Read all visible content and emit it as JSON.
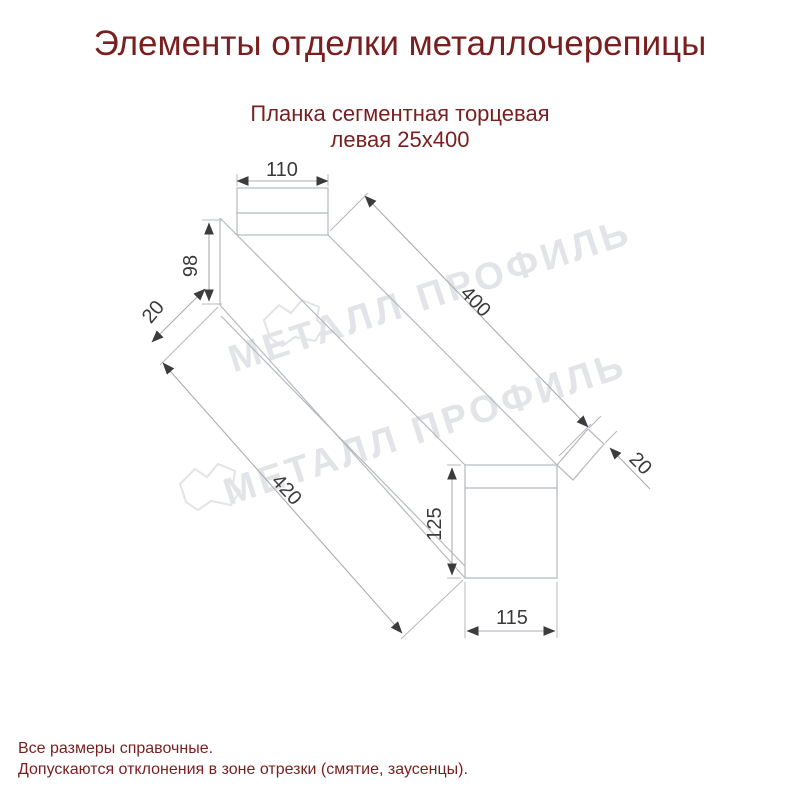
{
  "page": {
    "title": "Элементы отделки металлочерепицы"
  },
  "product": {
    "subtitle_line1": "Планка сегментная торцевая",
    "subtitle_line2": "левая 25х400"
  },
  "drawing": {
    "type": "isometric technical line drawing of left segmented end trim strip",
    "dimensions": {
      "top_flange_width": "110",
      "near_end_height": "98",
      "near_hem": "20",
      "top_length": "400",
      "bottom_length": "420",
      "far_end_height": "125",
      "far_end_width": "115",
      "far_hem": "20"
    }
  },
  "watermark": {
    "text": "МЕТАЛЛ ПРОФИЛЬ"
  },
  "footer": {
    "line1": "Все размеры справочные.",
    "line2": "Допускаются отклонения в зоне отрезки (смятие, заусенцы)."
  },
  "colors": {
    "heading_text": "#7a1f1f",
    "dimension_text": "#3a3a3a",
    "drawing_line": "#b5b9be",
    "watermark": "#e2e4e7",
    "background": "#ffffff"
  }
}
